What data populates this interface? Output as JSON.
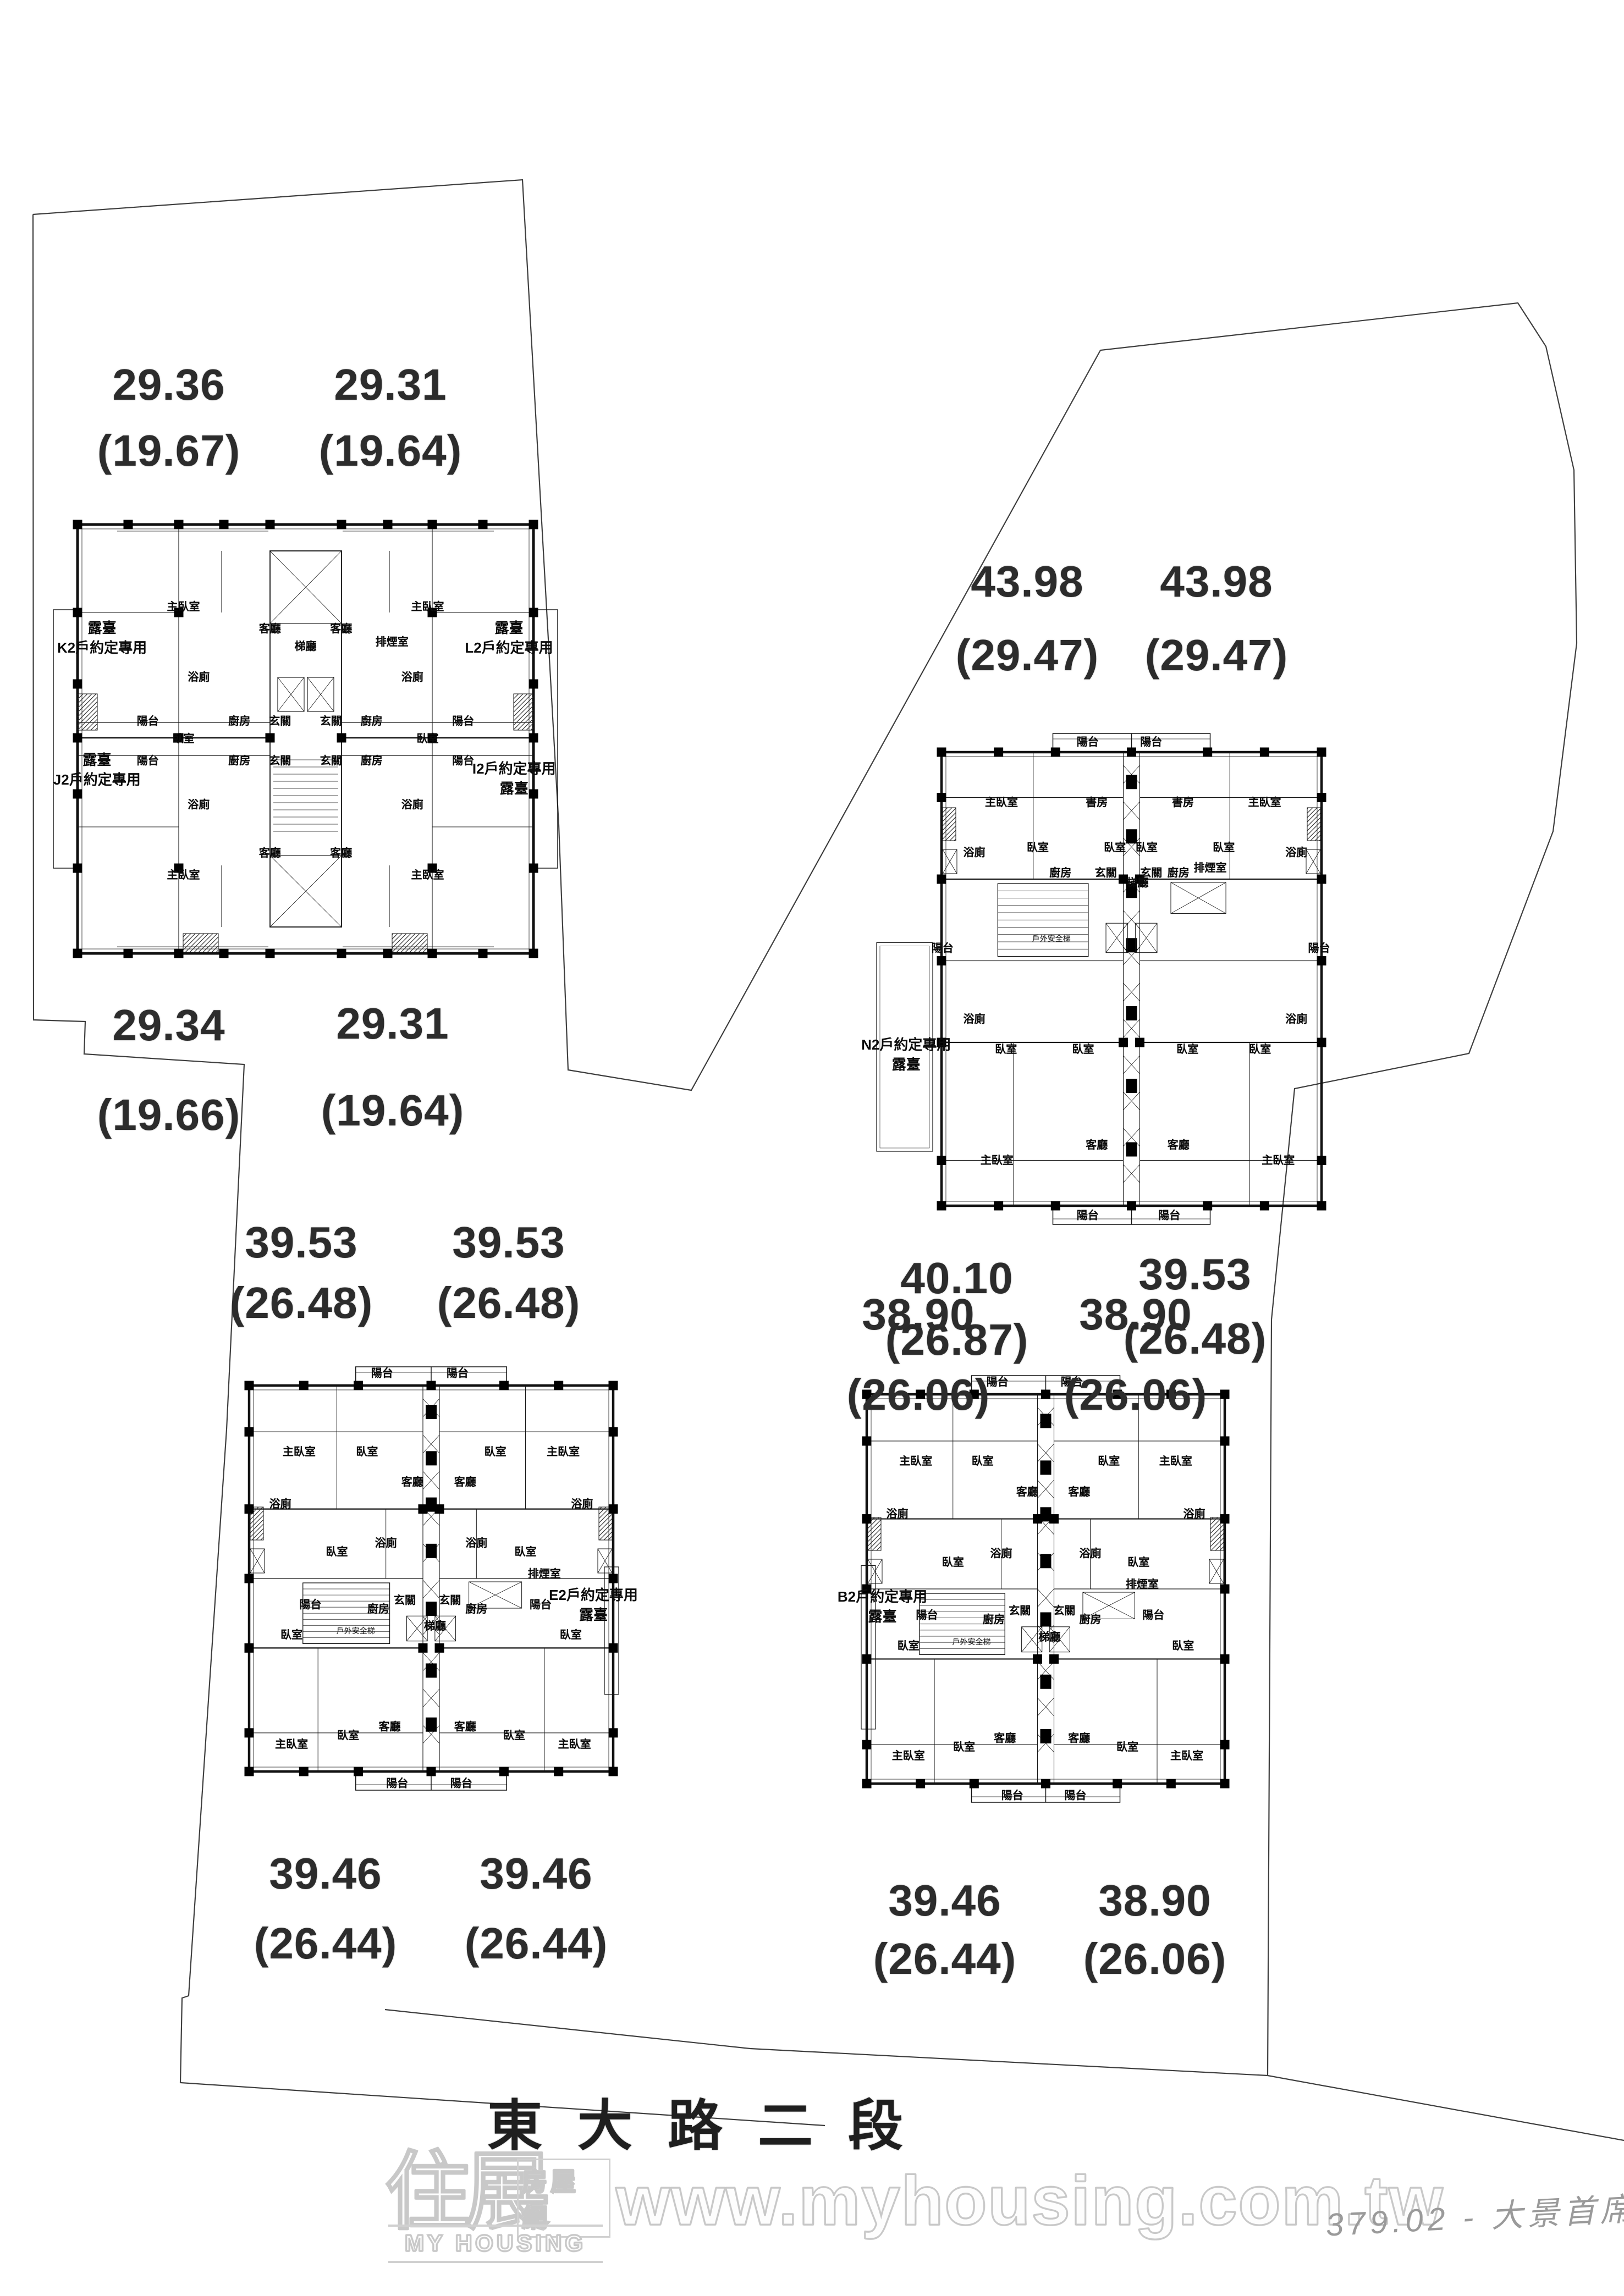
{
  "document": {
    "type": "site-and-floor-plan-scan"
  },
  "street": {
    "label": "東大路二段"
  },
  "watermark": {
    "logo_main": "住展",
    "logo_sub": "房屋網",
    "logo_caption": "MY HOUSING",
    "url": "www.myhousing.com.tw"
  },
  "handwriting": {
    "note": "379.02 - 大景首席"
  },
  "plans": [
    {
      "name": "building-top-left",
      "areas": {
        "top_left": {
          "main": "29.36",
          "sub": "(19.67)"
        },
        "top_right": {
          "main": "29.31",
          "sub": "(19.64)"
        },
        "bottom_left": {
          "main": "29.34",
          "sub": "(19.66)"
        },
        "bottom_right": {
          "main": "29.31",
          "sub": "(19.64)"
        }
      },
      "unit_labels": [
        [
          "露臺",
          "K2戶約定專用"
        ],
        [
          "露臺",
          "L2戶約定專用"
        ],
        [
          "露臺",
          "J2戶約定專用"
        ],
        [
          "I2戶約定專用",
          "露臺"
        ]
      ],
      "rooms": [
        "梯廳",
        "排煙室",
        "主臥室",
        "主臥室",
        "主臥室",
        "主臥室",
        "浴廁",
        "浴廁",
        "浴廁",
        "浴廁",
        "臥室",
        "臥室",
        "客廳",
        "客廳",
        "客廳",
        "客廳",
        "玄關",
        "玄關",
        "玄關",
        "玄關",
        "廚房",
        "廚房",
        "廚房",
        "廚房",
        "陽台",
        "陽台",
        "陽台",
        "陽台"
      ]
    },
    {
      "name": "building-right",
      "areas": {
        "top_left": {
          "main": "43.98",
          "sub": "(29.47)"
        },
        "top_right": {
          "main": "43.98",
          "sub": "(29.47)"
        },
        "bottom_left": {
          "main": "40.10",
          "sub": "(26.87)"
        },
        "bottom_right": {
          "main": "39.53",
          "sub": "(26.48)"
        }
      },
      "unit_labels": [
        [
          "N2戶約定專用",
          "露臺"
        ]
      ],
      "rooms": [
        "陽台",
        "陽台",
        "主臥室",
        "書房",
        "書房",
        "主臥室",
        "浴廁",
        "浴廁",
        "臥室",
        "臥室",
        "臥室",
        "臥室",
        "玄關",
        "玄關",
        "廚房",
        "廚房",
        "陽台",
        "陽台",
        "梯廳",
        "排煙室",
        "戶外安全梯",
        "浴廁",
        "浴廁",
        "臥室",
        "臥室",
        "臥室",
        "臥室",
        "客廳",
        "客廳",
        "主臥室",
        "主臥室",
        "陽台",
        "陽台"
      ]
    },
    {
      "name": "building-bottom-left",
      "areas": {
        "top_left": {
          "main": "39.53",
          "sub": "(26.48)"
        },
        "top_right": {
          "main": "39.53",
          "sub": "(26.48)"
        },
        "bottom_left": {
          "main": "39.46",
          "sub": "(26.44)"
        },
        "bottom_right": {
          "main": "39.46",
          "sub": "(26.44)"
        }
      },
      "unit_labels": [
        [
          "E2戶約定專用",
          "露臺"
        ]
      ],
      "rooms": [
        "陽台",
        "陽台",
        "主臥室",
        "主臥室",
        "臥室",
        "臥室",
        "浴廁",
        "浴廁",
        "客廳",
        "客廳",
        "臥室",
        "臥室",
        "浴廁",
        "浴廁",
        "玄關",
        "玄關",
        "廚房",
        "廚房",
        "陽台",
        "陽台",
        "梯廳",
        "排煙室",
        "戶外安全梯",
        "臥室",
        "臥室",
        "臥室",
        "臥室",
        "主臥室",
        "主臥室",
        "客廳",
        "客廳",
        "陽台",
        "陽台"
      ]
    },
    {
      "name": "building-bottom-right",
      "areas": {
        "top_left": {
          "main": "38.90",
          "sub": "(26.06)"
        },
        "top_right": {
          "main": "38.90",
          "sub": "(26.06)"
        },
        "bottom_left": {
          "main": "39.46",
          "sub": "(26.44)"
        },
        "bottom_right": {
          "main": "38.90",
          "sub": "(26.06)"
        }
      },
      "unit_labels": [
        [
          "B2戶約定專用",
          "露臺"
        ]
      ],
      "rooms": [
        "陽台",
        "陽台",
        "主臥室",
        "主臥室",
        "臥室",
        "臥室",
        "浴廁",
        "浴廁",
        "客廳",
        "客廳",
        "臥室",
        "臥室",
        "浴廁",
        "浴廁",
        "玄關",
        "玄關",
        "廚房",
        "廚房",
        "陽台",
        "陽台",
        "梯廳",
        "排煙室",
        "戶外安全梯",
        "臥室",
        "臥室",
        "臥室",
        "臥室",
        "主臥室",
        "主臥室",
        "客廳",
        "客廳",
        "陽台",
        "陽台"
      ]
    }
  ]
}
